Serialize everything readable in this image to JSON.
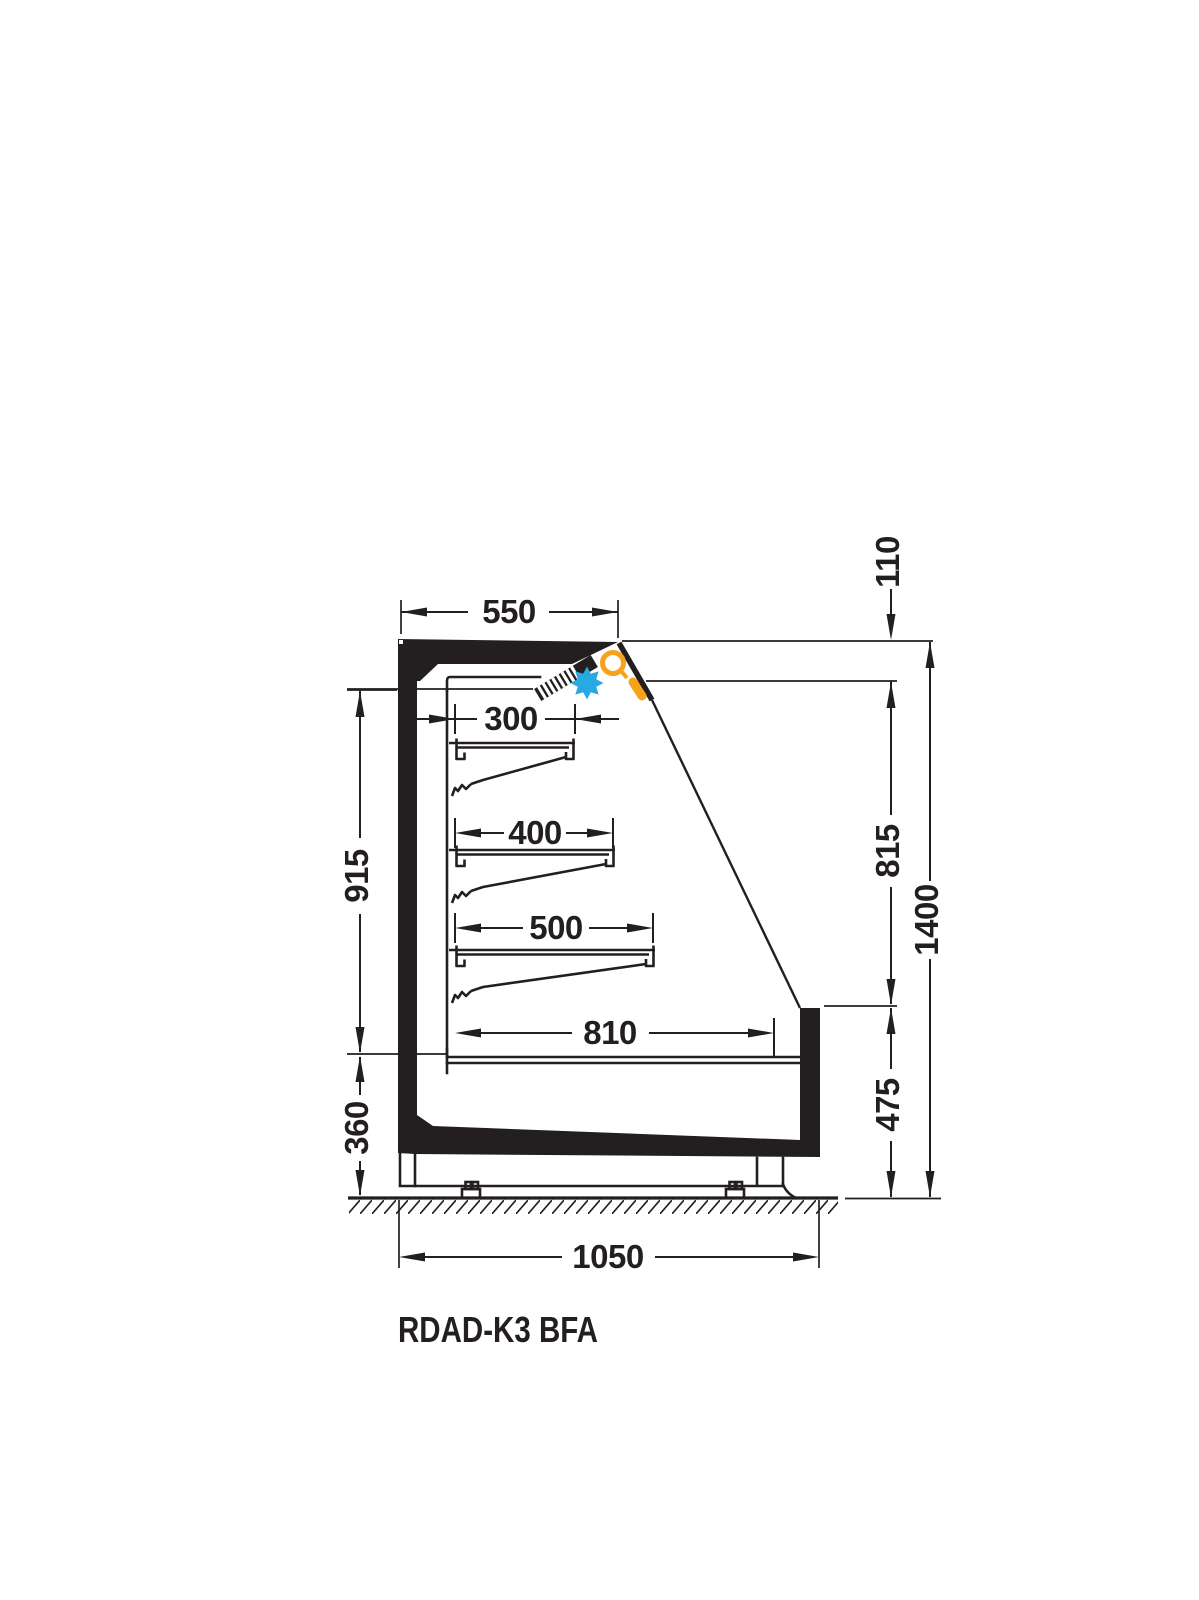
{
  "drawing": {
    "title": "RDAD-K3 BFA",
    "dims": {
      "top_depth": "550",
      "canopy_height": "110",
      "shelf_top": "300",
      "shelf_mid": "400",
      "shelf_low": "500",
      "deck_depth": "810",
      "interior_height": "915",
      "opening_height": "815",
      "base_height": "360",
      "front_height": "475",
      "total_depth": "1050",
      "total_height": "1400"
    },
    "colors": {
      "line": "#231f20",
      "fan_blue": "#29a9e1",
      "light_orange": "#f6a31c"
    },
    "icons": {
      "fan": "fan-icon",
      "light": "magnifier-icon"
    }
  }
}
